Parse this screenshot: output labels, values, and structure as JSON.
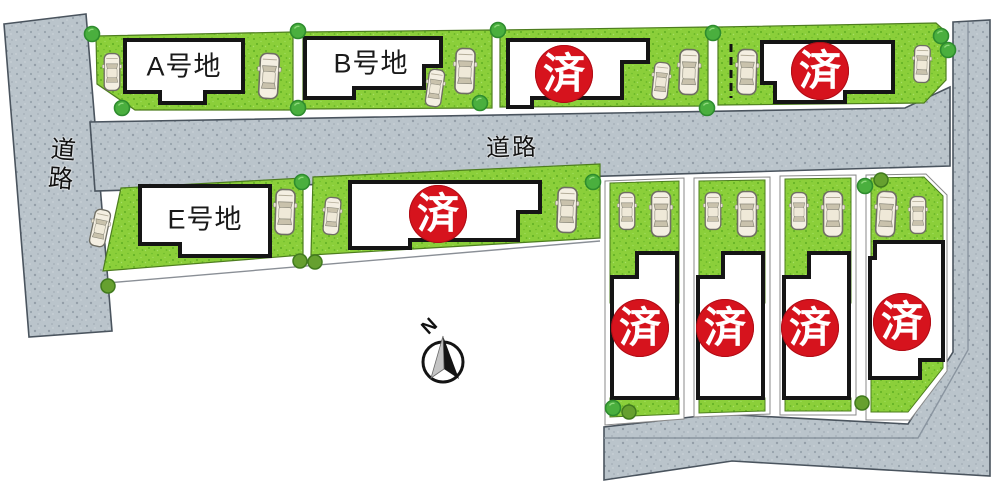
{
  "labels": {
    "sold_mark": "済",
    "road_left": "道路",
    "road_middle": "道路",
    "compass_north": "N"
  },
  "lots": [
    {
      "name": "A号地",
      "sold": false
    },
    {
      "name": "B号地",
      "sold": false
    },
    {
      "name": "",
      "sold": true
    },
    {
      "name": "",
      "sold": true
    },
    {
      "name": "E号地",
      "sold": false
    },
    {
      "name": "",
      "sold": true
    },
    {
      "name": "",
      "sold": true
    },
    {
      "name": "",
      "sold": true
    },
    {
      "name": "",
      "sold": true
    },
    {
      "name": "",
      "sold": true
    }
  ],
  "counts": {
    "total_lots": 10,
    "sold_lots": 7,
    "named_lots": 3
  },
  "colors": {
    "road": "#bac4cb",
    "road_edge": "#4a545e",
    "grass": "#8bcf3a",
    "grass_edge": "#4d7d1f",
    "house_fill": "#ffffff",
    "house_border": "#151515",
    "sold_red": "#d6131d",
    "tree": "#4aaf3e",
    "text": "#1a1a1a"
  }
}
